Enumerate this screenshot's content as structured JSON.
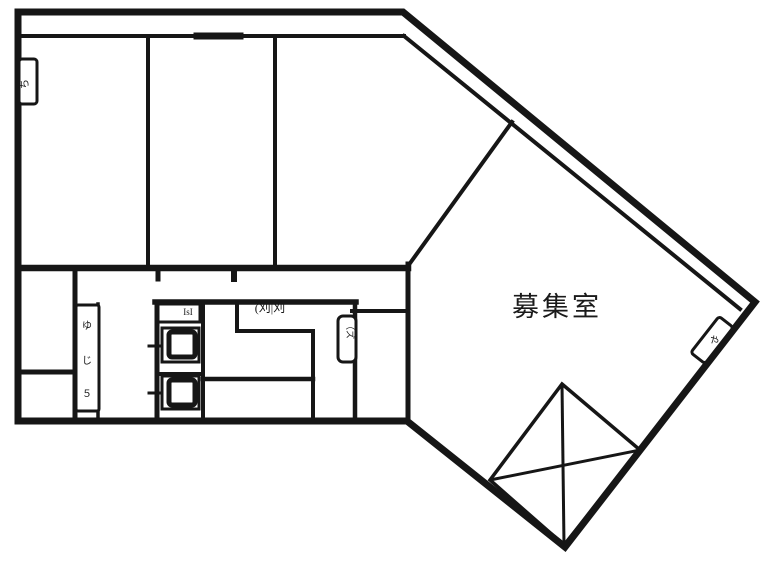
{
  "canvas": {
    "width": 773,
    "height": 561,
    "background": "#ffffff",
    "ink": "#161616"
  },
  "labels": {
    "main_room": {
      "text": "募集室",
      "x": 512,
      "y": 285,
      "font_size": 27
    }
  },
  "floorplan": {
    "outer_stroke": 7,
    "outer": [
      [
        18,
        12
      ],
      [
        403,
        12
      ],
      [
        755,
        302
      ],
      [
        565,
        547
      ],
      [
        407,
        421
      ],
      [
        18,
        421
      ]
    ],
    "walls": [
      [
        23,
        36,
        404,
        36,
        4
      ],
      [
        404,
        36,
        740,
        309,
        4
      ],
      [
        148,
        36,
        148,
        268,
        4
      ],
      [
        275,
        36,
        275,
        268,
        4
      ],
      [
        20,
        268,
        408,
        268,
        6.5
      ],
      [
        408,
        266,
        512,
        122,
        4
      ],
      [
        408,
        264,
        408,
        421,
        5
      ],
      [
        75,
        268,
        75,
        421,
        5
      ],
      [
        98,
        304,
        98,
        421,
        3.5
      ],
      [
        20,
        372,
        75,
        372,
        5
      ],
      [
        155,
        302,
        356,
        302,
        5.5
      ],
      [
        157,
        302,
        157,
        421,
        5
      ],
      [
        203,
        302,
        203,
        421,
        4
      ],
      [
        157,
        374,
        203,
        374,
        4
      ],
      [
        237,
        302,
        237,
        331,
        4
      ],
      [
        237,
        331,
        313,
        331,
        4
      ],
      [
        313,
        331,
        313,
        421,
        4
      ],
      [
        203,
        379,
        313,
        379,
        4.5
      ],
      [
        355,
        302,
        355,
        421,
        4.5
      ],
      [
        352,
        311,
        408,
        311,
        4
      ],
      [
        197,
        36,
        240,
        36,
        7
      ],
      [
        158,
        268,
        158,
        279,
        5
      ],
      [
        234,
        268,
        234,
        279,
        6
      ],
      [
        149,
        346,
        165,
        346,
        3
      ],
      [
        149,
        393,
        165,
        393,
        3
      ],
      [
        76,
        348,
        99,
        348,
        3
      ],
      [
        76,
        378,
        99,
        378,
        3
      ]
    ],
    "boxes": [
      {
        "name": "wall-meter-box-left",
        "x": 19,
        "y": 59,
        "w": 18,
        "h": 45,
        "s": 3,
        "rx": 3,
        "rot": 0
      },
      {
        "name": "vanity-strip",
        "x": 76,
        "y": 305,
        "w": 23,
        "h": 106,
        "s": 3,
        "rx": 2,
        "rot": 0
      },
      {
        "name": "counter-box",
        "x": 158,
        "y": 304,
        "w": 42,
        "h": 18,
        "s": 3,
        "rx": 0,
        "rot": 0
      },
      {
        "name": "fixture-box-rounded",
        "x": 338,
        "y": 316,
        "w": 18,
        "h": 46,
        "s": 3,
        "rx": 5,
        "rot": 0
      },
      {
        "name": "toilet-upper-stall",
        "x": 162,
        "y": 328,
        "w": 37,
        "h": 34,
        "s": 3,
        "rx": 0,
        "rot": 0
      },
      {
        "name": "toilet-upper-bowl",
        "x": 169,
        "y": 332,
        "w": 26,
        "h": 25,
        "s": 5,
        "rx": 3,
        "rot": 0
      },
      {
        "name": "toilet-lower-stall",
        "x": 162,
        "y": 376,
        "w": 37,
        "h": 33,
        "s": 3,
        "rx": 0,
        "rot": 0
      },
      {
        "name": "toilet-lower-bowl",
        "x": 169,
        "y": 380,
        "w": 26,
        "h": 25,
        "s": 5,
        "rx": 3,
        "rot": 0
      },
      {
        "name": "wall-meter-box-right",
        "x": 703,
        "y": 317,
        "w": 18,
        "h": 46,
        "s": 3,
        "rx": 3,
        "rot": 38
      }
    ],
    "diamond": {
      "points": [
        [
          562,
          384
        ],
        [
          640,
          450
        ],
        [
          564,
          545
        ],
        [
          490,
          480
        ]
      ],
      "stroke": 3.5,
      "cross": [
        [
          562,
          384,
          564,
          545
        ],
        [
          490,
          480,
          640,
          450
        ]
      ],
      "cross_stroke": 3
    },
    "glyphs": [
      {
        "text": "ち",
        "x": 28,
        "y": 84,
        "size": 10,
        "rot": -90
      },
      {
        "text": "ゆ",
        "x": 87,
        "y": 329,
        "size": 10,
        "rot": 0
      },
      {
        "text": "じ",
        "x": 87,
        "y": 364,
        "size": 10,
        "rot": 0
      },
      {
        "text": "５",
        "x": 87,
        "y": 397,
        "size": 10,
        "rot": 0
      },
      {
        "text": "IsI",
        "x": 188,
        "y": 315,
        "size": 9,
        "rot": 0
      },
      {
        "text": "(刈|刈",
        "x": 270,
        "y": 312,
        "size": 12,
        "rot": 0
      },
      {
        "text": "（ズ",
        "x": 347,
        "y": 330,
        "size": 9,
        "rot": 90
      },
      {
        "text": "や",
        "x": 712,
        "y": 343,
        "size": 10,
        "rot": 38
      }
    ]
  }
}
